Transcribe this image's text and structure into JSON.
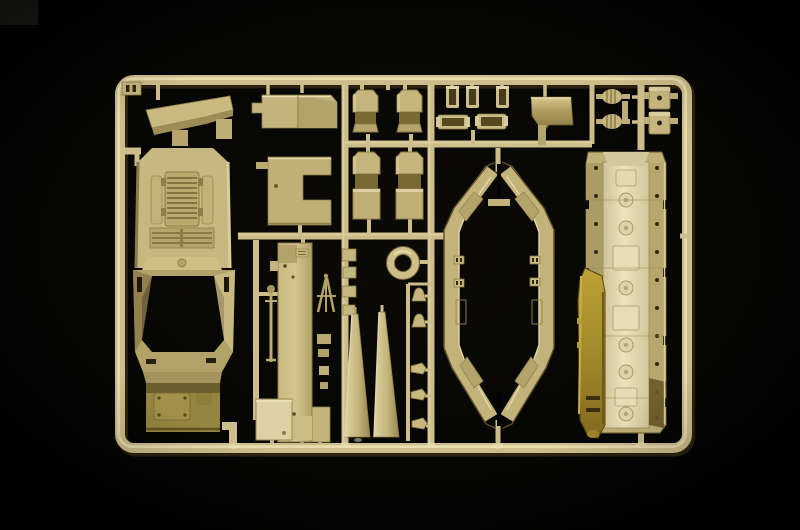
{
  "scene": {
    "type": "photograph",
    "subject": "injection-molded plastic model kit sprue (parts tree) with tan parts, photographed on a black background",
    "orientation": "landscape",
    "lighting": "single soft light, brighter center, dark vignetted corners"
  },
  "palette": {
    "bg": "#040404",
    "rail": "#cdbd8a",
    "rail_hi": "#ece1b4",
    "rail_sh": "#2f2610",
    "tan": "#c6b67e",
    "tan_dark": "#a5954e",
    "olive": "#94853f",
    "cream": "#e7deb7",
    "gold": "#a68c2c",
    "detail": "#857546",
    "dark_dot": "#2e2712",
    "corner_patch": "#1e1e1c"
  },
  "sprue": {
    "frame": {
      "left": 121,
      "top": 80,
      "right": 687,
      "bottom": 448,
      "corner_radius": 14,
      "rail_thickness": 10
    },
    "id_tab_marks": 2,
    "parts": [
      {
        "name": "roof-wing-slab",
        "count": 1
      },
      {
        "name": "notched-plate",
        "count": 1
      },
      {
        "name": "hull-roof-with-engine-deck",
        "count": 1
      },
      {
        "name": "side-access-plate",
        "count": 1
      },
      {
        "name": "fender-panel-short",
        "count": 2
      },
      {
        "name": "fender-panel-long",
        "count": 2
      },
      {
        "name": "sleeve-bracket",
        "count": 3
      },
      {
        "name": "channel-bracket",
        "count": 2
      },
      {
        "name": "angled-gold-plate",
        "count": 1
      },
      {
        "name": "ribbed-exhaust-roller",
        "count": 2
      },
      {
        "name": "hatch-box",
        "count": 2
      },
      {
        "name": "long-plank-panel",
        "count": 1
      },
      {
        "name": "equipment-box",
        "count": 1
      },
      {
        "name": "antenna-rod",
        "count": 1
      },
      {
        "name": "tripod-mount",
        "count": 1
      },
      {
        "name": "ring-mount",
        "count": 1
      },
      {
        "name": "skid-wedge",
        "count": 2
      },
      {
        "name": "periscope-knob",
        "count": 2
      },
      {
        "name": "leaf-bracket",
        "count": 3
      },
      {
        "name": "hull-side-frame-octagon",
        "count": 1
      },
      {
        "name": "belly-panel-riveted",
        "count": 1
      },
      {
        "name": "gold-blade-panel",
        "count": 1
      },
      {
        "name": "runner-gate-square",
        "count": 4
      }
    ]
  }
}
